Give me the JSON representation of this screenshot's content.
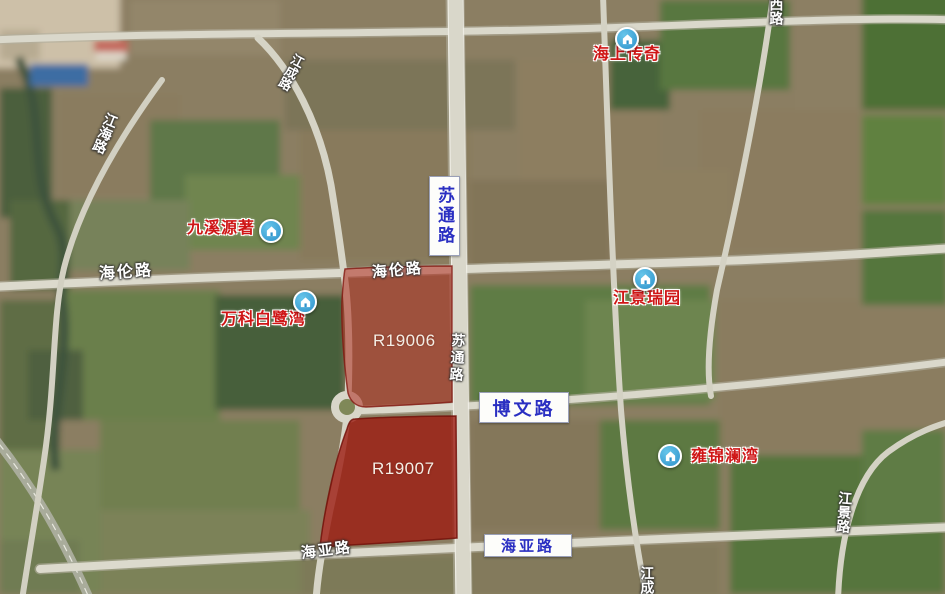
{
  "colors": {
    "parcel_fill_light": "#af2b1f",
    "parcel_fill_dark": "#9c1c11",
    "poi_label_red": "#cf1616",
    "road_sign_blue": "#2a2fc2",
    "poi_icon_blue": "#3aa3da",
    "road_label_white": "#ffffff"
  },
  "parcels": [
    {
      "id": "R19006"
    },
    {
      "id": "R19007"
    }
  ],
  "poi": [
    {
      "name": "海上传奇"
    },
    {
      "name": "九溪源著"
    },
    {
      "name": "万科白鹭湾"
    },
    {
      "name": "江景瑞园"
    },
    {
      "name": "雍锦澜湾"
    }
  ],
  "road_signs": [
    {
      "name": "苏通路"
    },
    {
      "name": "博文路"
    },
    {
      "name": "海亚路"
    }
  ],
  "road_labels": [
    {
      "name": "江成路"
    },
    {
      "name": "江海路"
    },
    {
      "name": "海伦路"
    },
    {
      "name": "海伦路"
    },
    {
      "name": "苏通路"
    },
    {
      "name": "海亚路"
    },
    {
      "name": "江景路"
    },
    {
      "name": "西路"
    },
    {
      "name": "江成"
    }
  ]
}
